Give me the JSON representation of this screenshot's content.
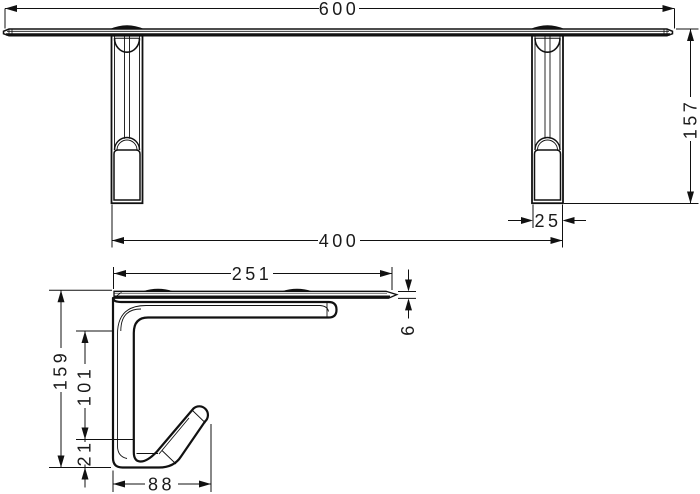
{
  "drawing": {
    "background": "#ffffff",
    "line_color": "#111111",
    "front": {
      "width": "600",
      "height": "157",
      "post_width": "25",
      "mount_span": "400"
    },
    "side": {
      "depth": "251",
      "shelf_thickness": "6",
      "height": "159",
      "hook_clearance": "101",
      "hook_bottom": "21",
      "hook_depth": "88"
    }
  }
}
